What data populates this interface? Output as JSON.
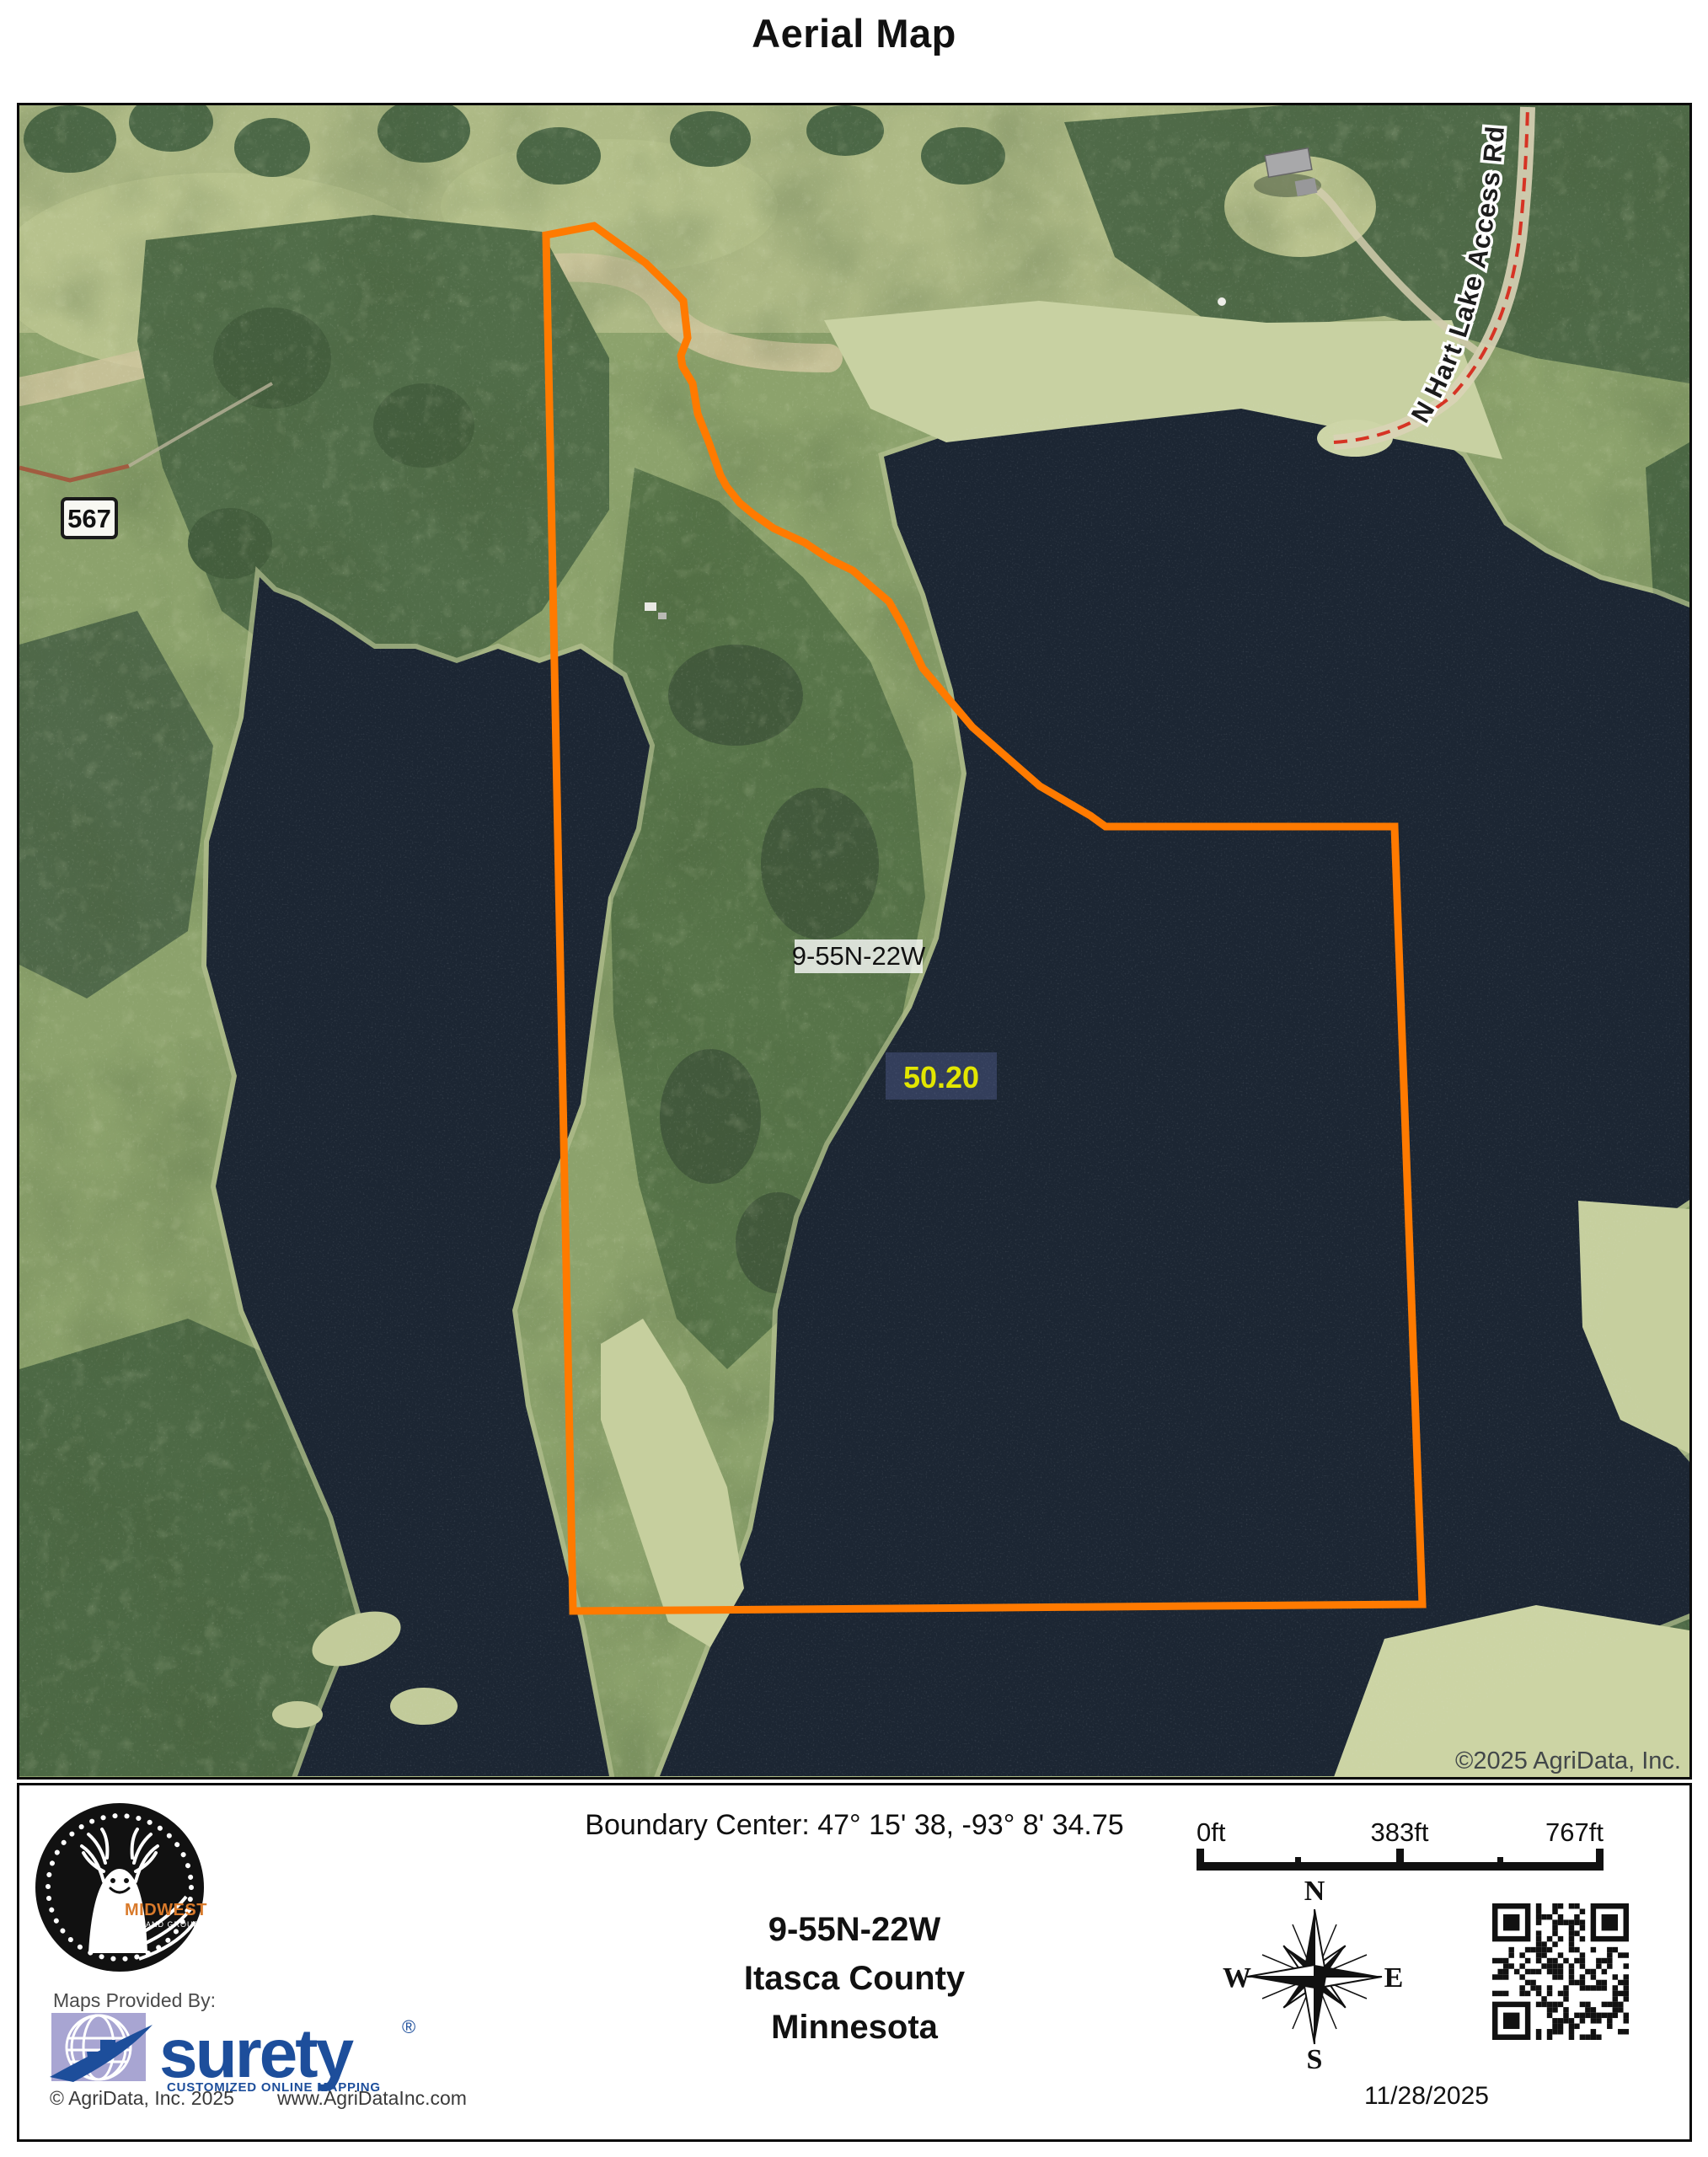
{
  "page": {
    "title": "Aerial Map"
  },
  "map": {
    "route_marker": "567",
    "road_label": "N Hart Lake Access Rd",
    "parcel_label": "9-55N-22W",
    "acres_label": "50.20",
    "copyright": "©2025 AgriData, Inc.",
    "boundary_color": "#FF7A00",
    "acres_color": "#E2E600",
    "water_color": "#1C2633",
    "forest_color": "#516D49",
    "marsh_color": "#C8D1A2"
  },
  "footer": {
    "boundary_center": "Boundary Center: 47° 15' 38,  -93° 8' 34.75",
    "township": "9-55N-22W",
    "county": "Itasca County",
    "state": "Minnesota",
    "date": "11/28/2025",
    "scalebar": {
      "start": "0ft",
      "middle": "383ft",
      "end": "767ft"
    },
    "compass": {
      "north": "N",
      "east": "E",
      "south": "S",
      "west": "W"
    },
    "provider": {
      "label": "Maps Provided By:",
      "brand": "surety",
      "registered": "®",
      "tagline": "CUSTOMIZED ONLINE MAPPING",
      "copyright": "© AgriData, Inc. 2025",
      "website": "www.AgriDataInc.com",
      "brand_color": "#1D4E9B",
      "globe_color": "#A8A5D2"
    },
    "logo": {
      "name": "MIDWEST",
      "sub": "LAND GROUP",
      "accent": "#D97A2B"
    }
  }
}
